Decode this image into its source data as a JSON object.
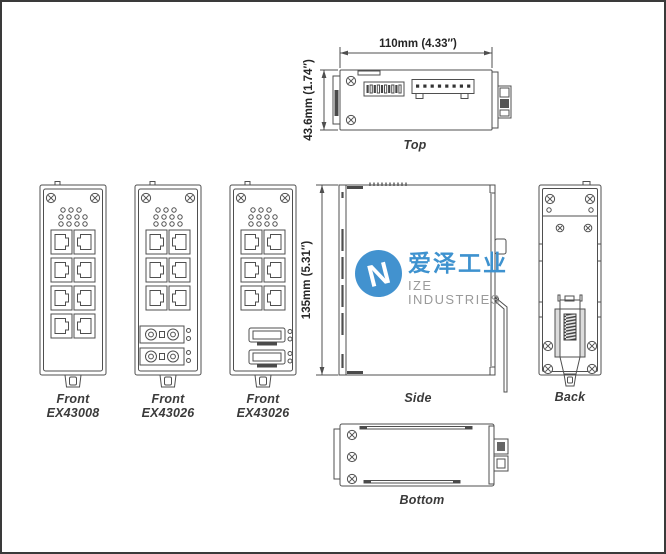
{
  "colors": {
    "background": "#FFFFFF",
    "page_border": "#3A3A3A",
    "line": "#4F4F4F",
    "dark_fill": "#4A4A4A",
    "label_text": "#3A3A3A",
    "dim_text": "#262626",
    "logo_blue": "#3E92CF",
    "logo_text_gray": "#9A9A9A"
  },
  "views": {
    "top": {
      "label": "Top",
      "dim_width": "110mm (4.33″)",
      "dim_height": "43.6mm (1.74″)"
    },
    "front_ex43008": {
      "label": "Front",
      "model": "EX43008"
    },
    "front_ex43026_fiber": {
      "label": "Front",
      "model": "EX43026"
    },
    "front_ex43026_sfp": {
      "label": "Front",
      "model": "EX43026"
    },
    "side": {
      "label": "Side",
      "dim_height": "135mm (5.31″)"
    },
    "back": {
      "label": "Back"
    },
    "bottom": {
      "label": "Bottom"
    }
  },
  "watermark": {
    "brand_cn": "爱泽工业",
    "brand_en": "IZE INDUSTRIES",
    "logo_letter": "N"
  }
}
